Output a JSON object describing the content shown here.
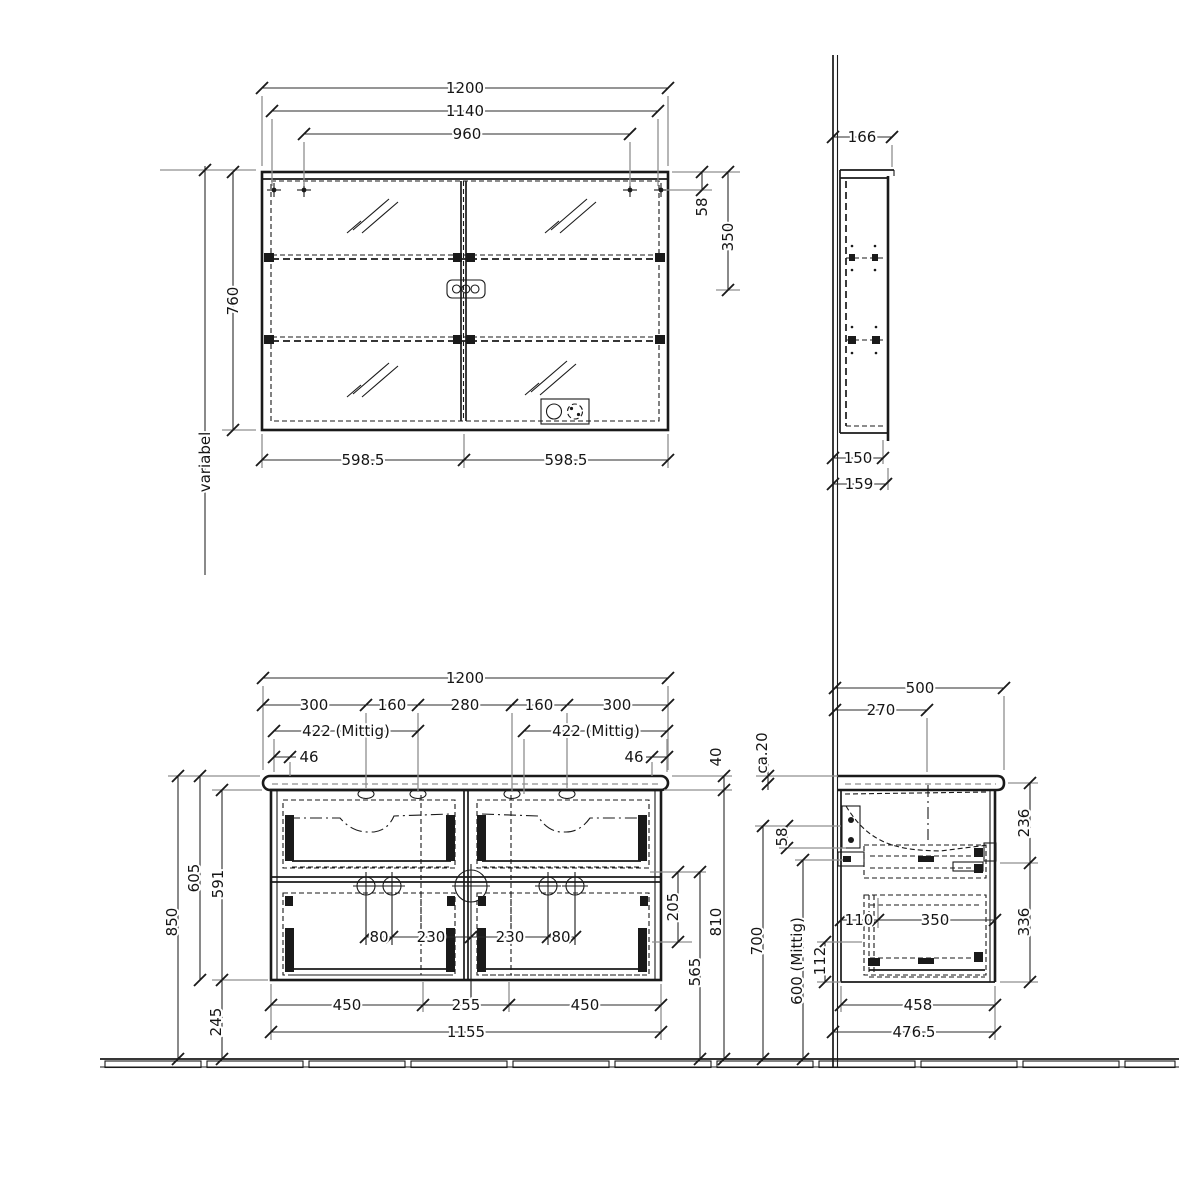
{
  "meta": {
    "description": "Dimensioned technical line drawing (mm): bathroom mirror cabinet and double-basin vanity unit, front and side views, wall and floor reference lines"
  },
  "mf": {
    "w1200": "1200",
    "w1140": "1140",
    "w960": "960",
    "h760": "760",
    "variabel": "variabel",
    "b598l": "598.5",
    "b598r": "598.5",
    "r58": "58",
    "r350": "350"
  },
  "ms": {
    "d166": "166",
    "d150": "150",
    "d159": "159"
  },
  "vf": {
    "w1200": "1200",
    "s300l": "300",
    "s160l": "160",
    "s280": "280",
    "s160r": "160",
    "s300r": "300",
    "mittig_l": "422 (Mittig)",
    "mittig_r": "422 (Mittig)",
    "o46l": "46",
    "o46r": "46",
    "t40": "40",
    "h850": "850",
    "h605": "605",
    "h591": "591",
    "h245": "245",
    "i80l": "80",
    "i230l": "230",
    "i230r": "230",
    "i80r": "80",
    "r205": "205",
    "r565": "565",
    "r810": "810",
    "b450l": "450",
    "b255": "255",
    "b450r": "450",
    "b1155": "1155"
  },
  "vs": {
    "w500": "500",
    "w270": "270",
    "ca20": "ca.20",
    "o58": "58",
    "h700": "700",
    "h600": "600 (Mittig)",
    "h112": "112",
    "i110": "110",
    "i350": "350",
    "r236": "236",
    "r336": "336",
    "b458": "458",
    "b476": "476.5"
  }
}
